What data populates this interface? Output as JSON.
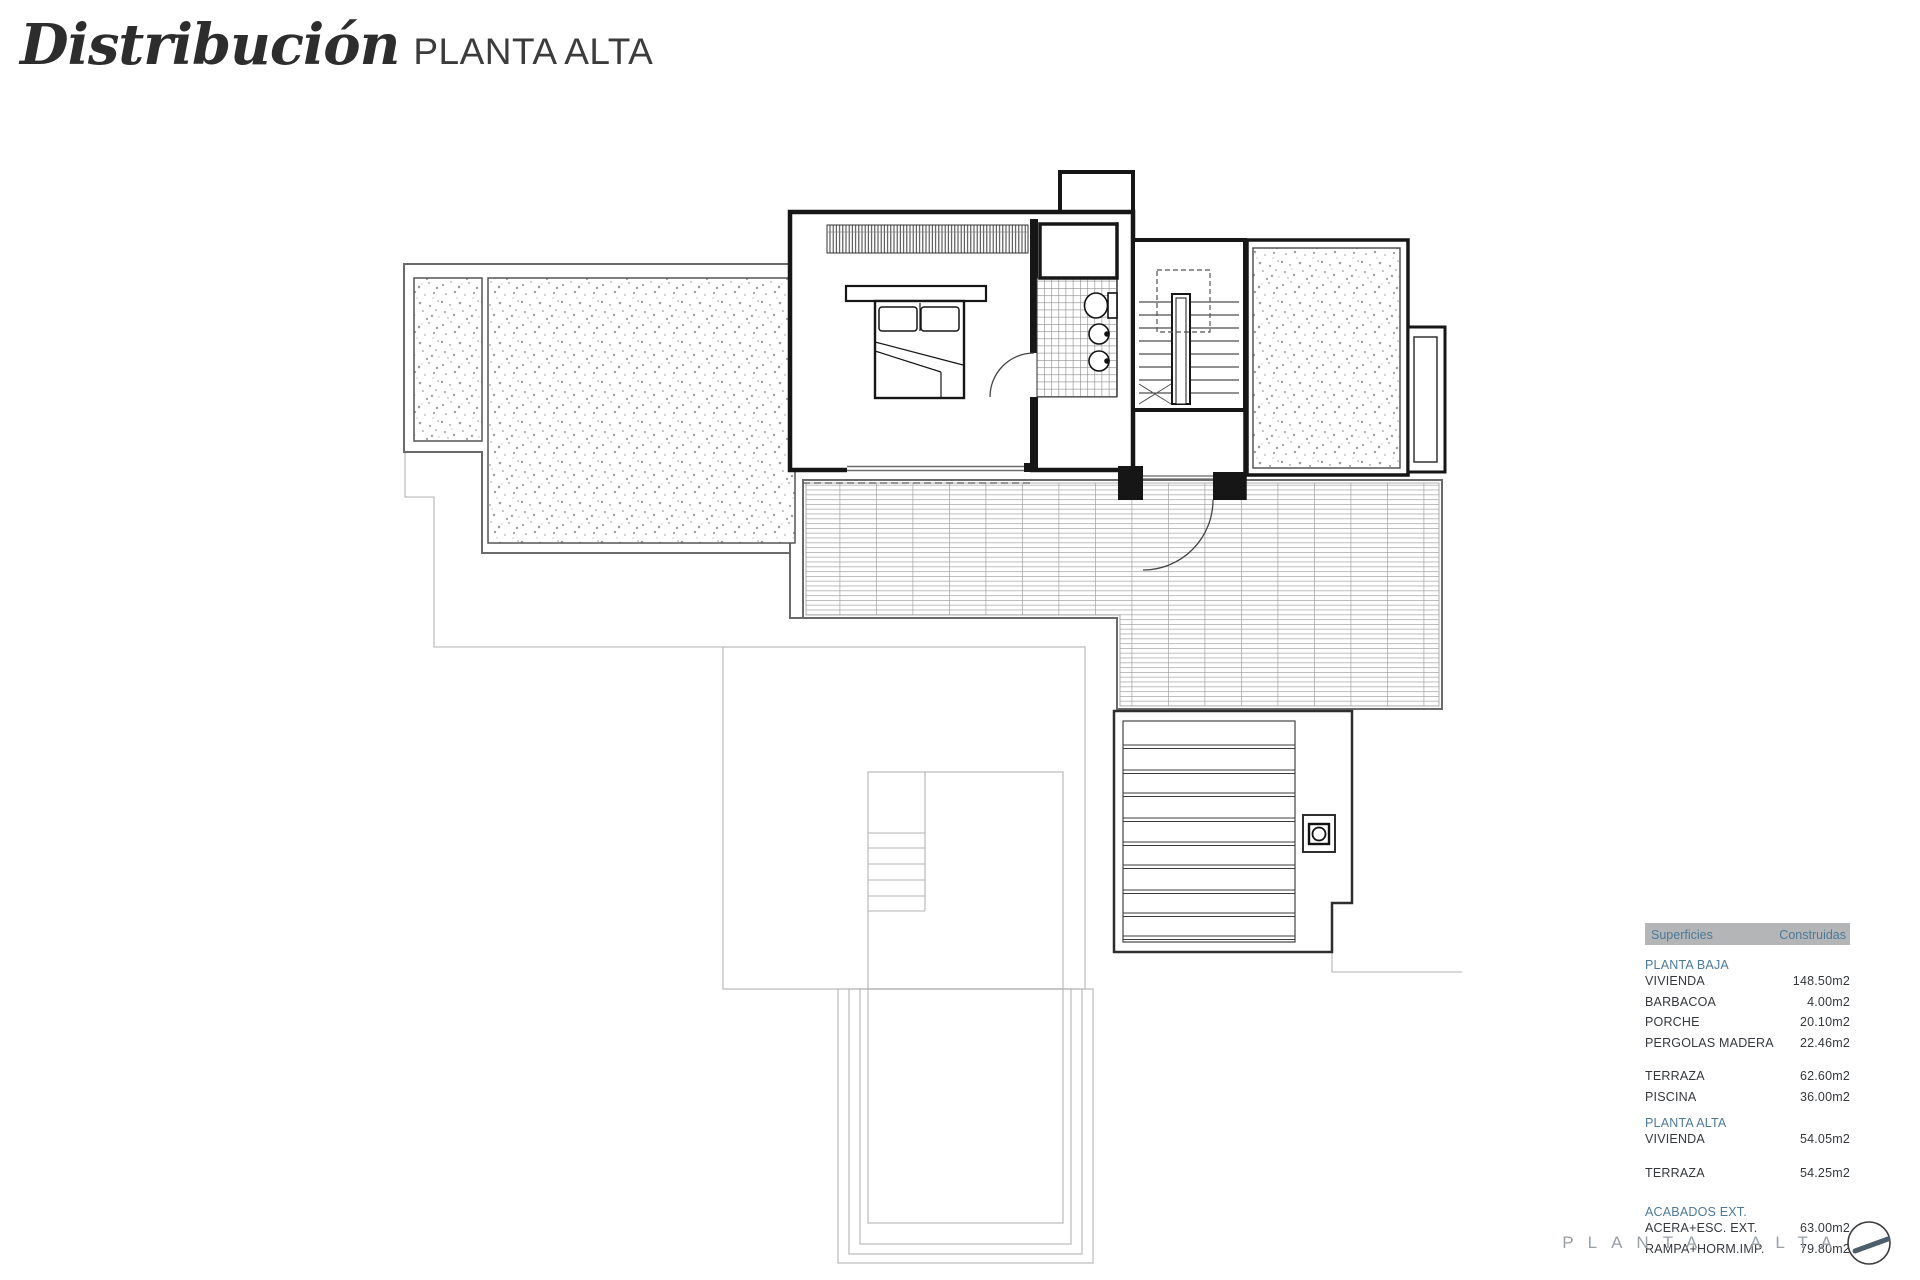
{
  "title": {
    "main": "Distribución",
    "sub": "PLANTA ALTA"
  },
  "table": {
    "header": {
      "left": "Superficies",
      "right": "Construidas"
    },
    "rows": [
      {
        "type": "heading",
        "label": "PLANTA BAJA"
      },
      {
        "type": "item",
        "label": "VIVIENDA",
        "value": "148.50m2"
      },
      {
        "type": "item",
        "label": "BARBACOA",
        "value": "4.00m2"
      },
      {
        "type": "item",
        "label": "PORCHE",
        "value": "20.10m2"
      },
      {
        "type": "item",
        "label": "PERGOLAS MADERA",
        "value": "22.46m2"
      },
      {
        "type": "spacer"
      },
      {
        "type": "item",
        "label": "TERRAZA",
        "value": "62.60m2"
      },
      {
        "type": "item",
        "label": "PISCINA",
        "value": "36.00m2"
      },
      {
        "type": "heading",
        "label": "PLANTA ALTA"
      },
      {
        "type": "item",
        "label": "VIVIENDA",
        "value": "54.05m2"
      },
      {
        "type": "spacer"
      },
      {
        "type": "item",
        "label": "TERRAZA",
        "value": "54.25m2"
      },
      {
        "type": "spacer"
      },
      {
        "type": "heading",
        "label": "ACABADOS EXT."
      },
      {
        "type": "item",
        "label": "ACERA+ESC. EXT.",
        "value": "63.00m2"
      },
      {
        "type": "item",
        "label": "RAMPA+HORM.IMP.",
        "value": "79.80m2"
      }
    ]
  },
  "footer": {
    "label": "PLANTA ALTA",
    "icon": "north-arrow-icon"
  },
  "colors": {
    "accent": "#4d7a99",
    "table_header_bg": "#b4b5b7",
    "body_text": "#34383c",
    "muted_label": "#98a0a6",
    "wall": "#161616"
  }
}
